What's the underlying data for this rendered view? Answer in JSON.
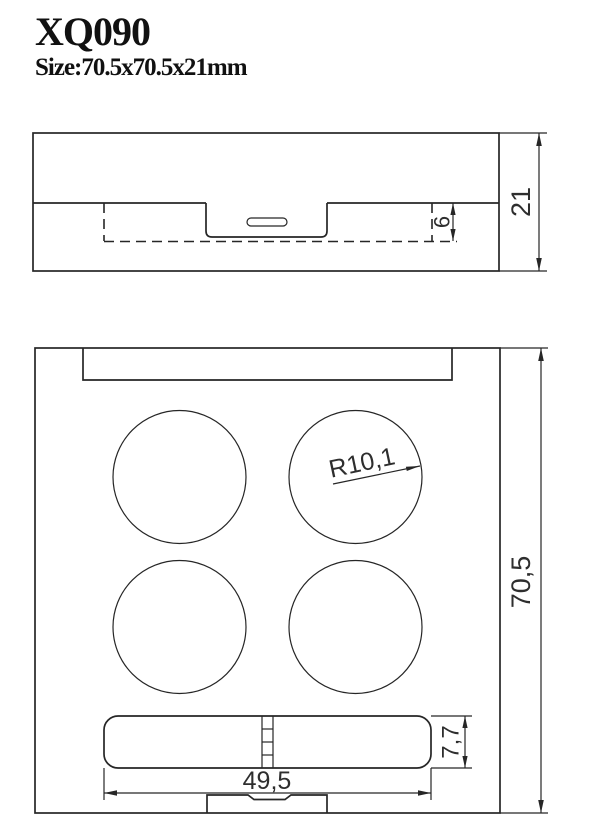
{
  "header": {
    "model": "XQ090",
    "size_label": "Size:70.5x70.5x21mm"
  },
  "side_view": {
    "dim_total_height": "21",
    "dim_inner_depth": "6"
  },
  "top_view": {
    "dim_total_width": "70,5",
    "dim_hinge_length": "49,5",
    "dim_hinge_width": "7,7",
    "dim_well_radius": "R10,1"
  },
  "colors": {
    "line": "#262626",
    "text": "#111111",
    "background": "#ffffff"
  }
}
